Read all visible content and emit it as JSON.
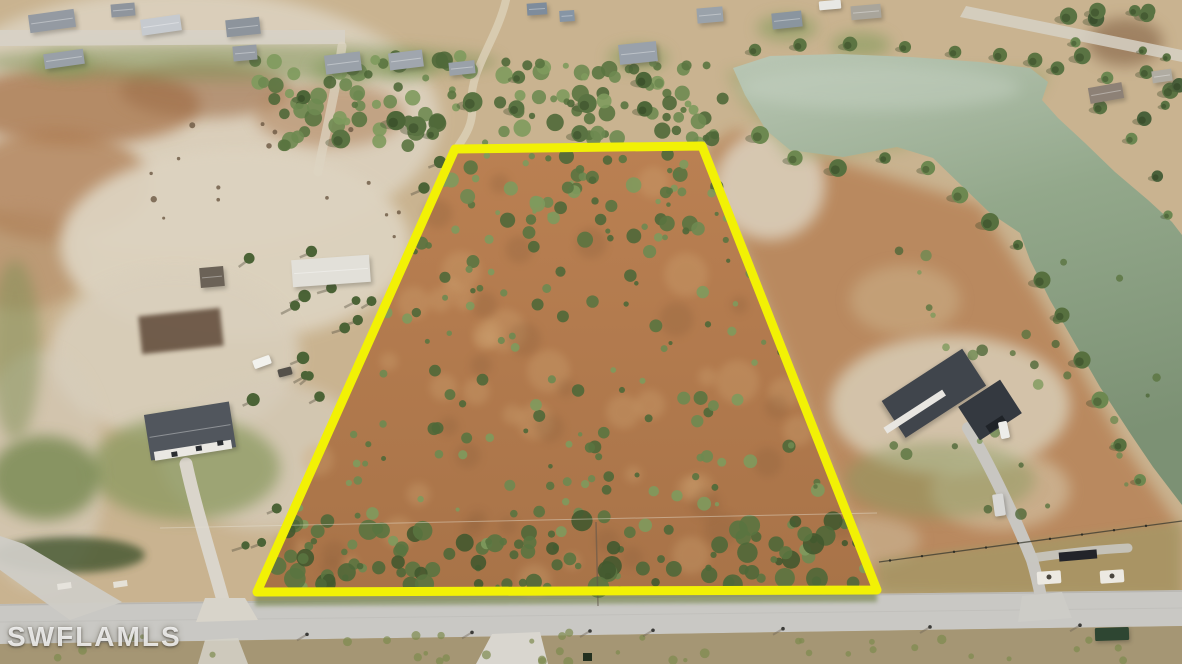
{
  "image": {
    "type": "aerial-drone-photograph",
    "subject": "vacant land parcel highlighted with yellow boundary outline",
    "width_px": 1182,
    "height_px": 664
  },
  "watermark": {
    "text": "SWFLAMLS"
  },
  "parcel": {
    "outline_points": "455,149 702,146 877,590 257,592",
    "outline_color": "#f2f105",
    "outline_width": 9,
    "interior_description": "cleared scrub land, orange-brown brush with scattered green shrubs"
  },
  "features": {
    "pond": "large grey-green pond upper right with channel running down right edge",
    "street": "paved road across bottom of frame",
    "left_house": "white house with dark grey roof, left side",
    "right_house": "grey-roof house with driveway, right side",
    "outbuildings": "light metal shed and small dark shed on left compound",
    "neighborhood": "scattered single-family homes along top edge"
  },
  "palette": {
    "ground_tan": "#c9b390",
    "sand_light": "#dcd2bf",
    "scrub_brown": "#b37a4d",
    "vegetation_green": "#647d45",
    "pond_water": "#8ba183",
    "road_gray": "#c9c8c4",
    "roof_gray": "#51565d"
  }
}
